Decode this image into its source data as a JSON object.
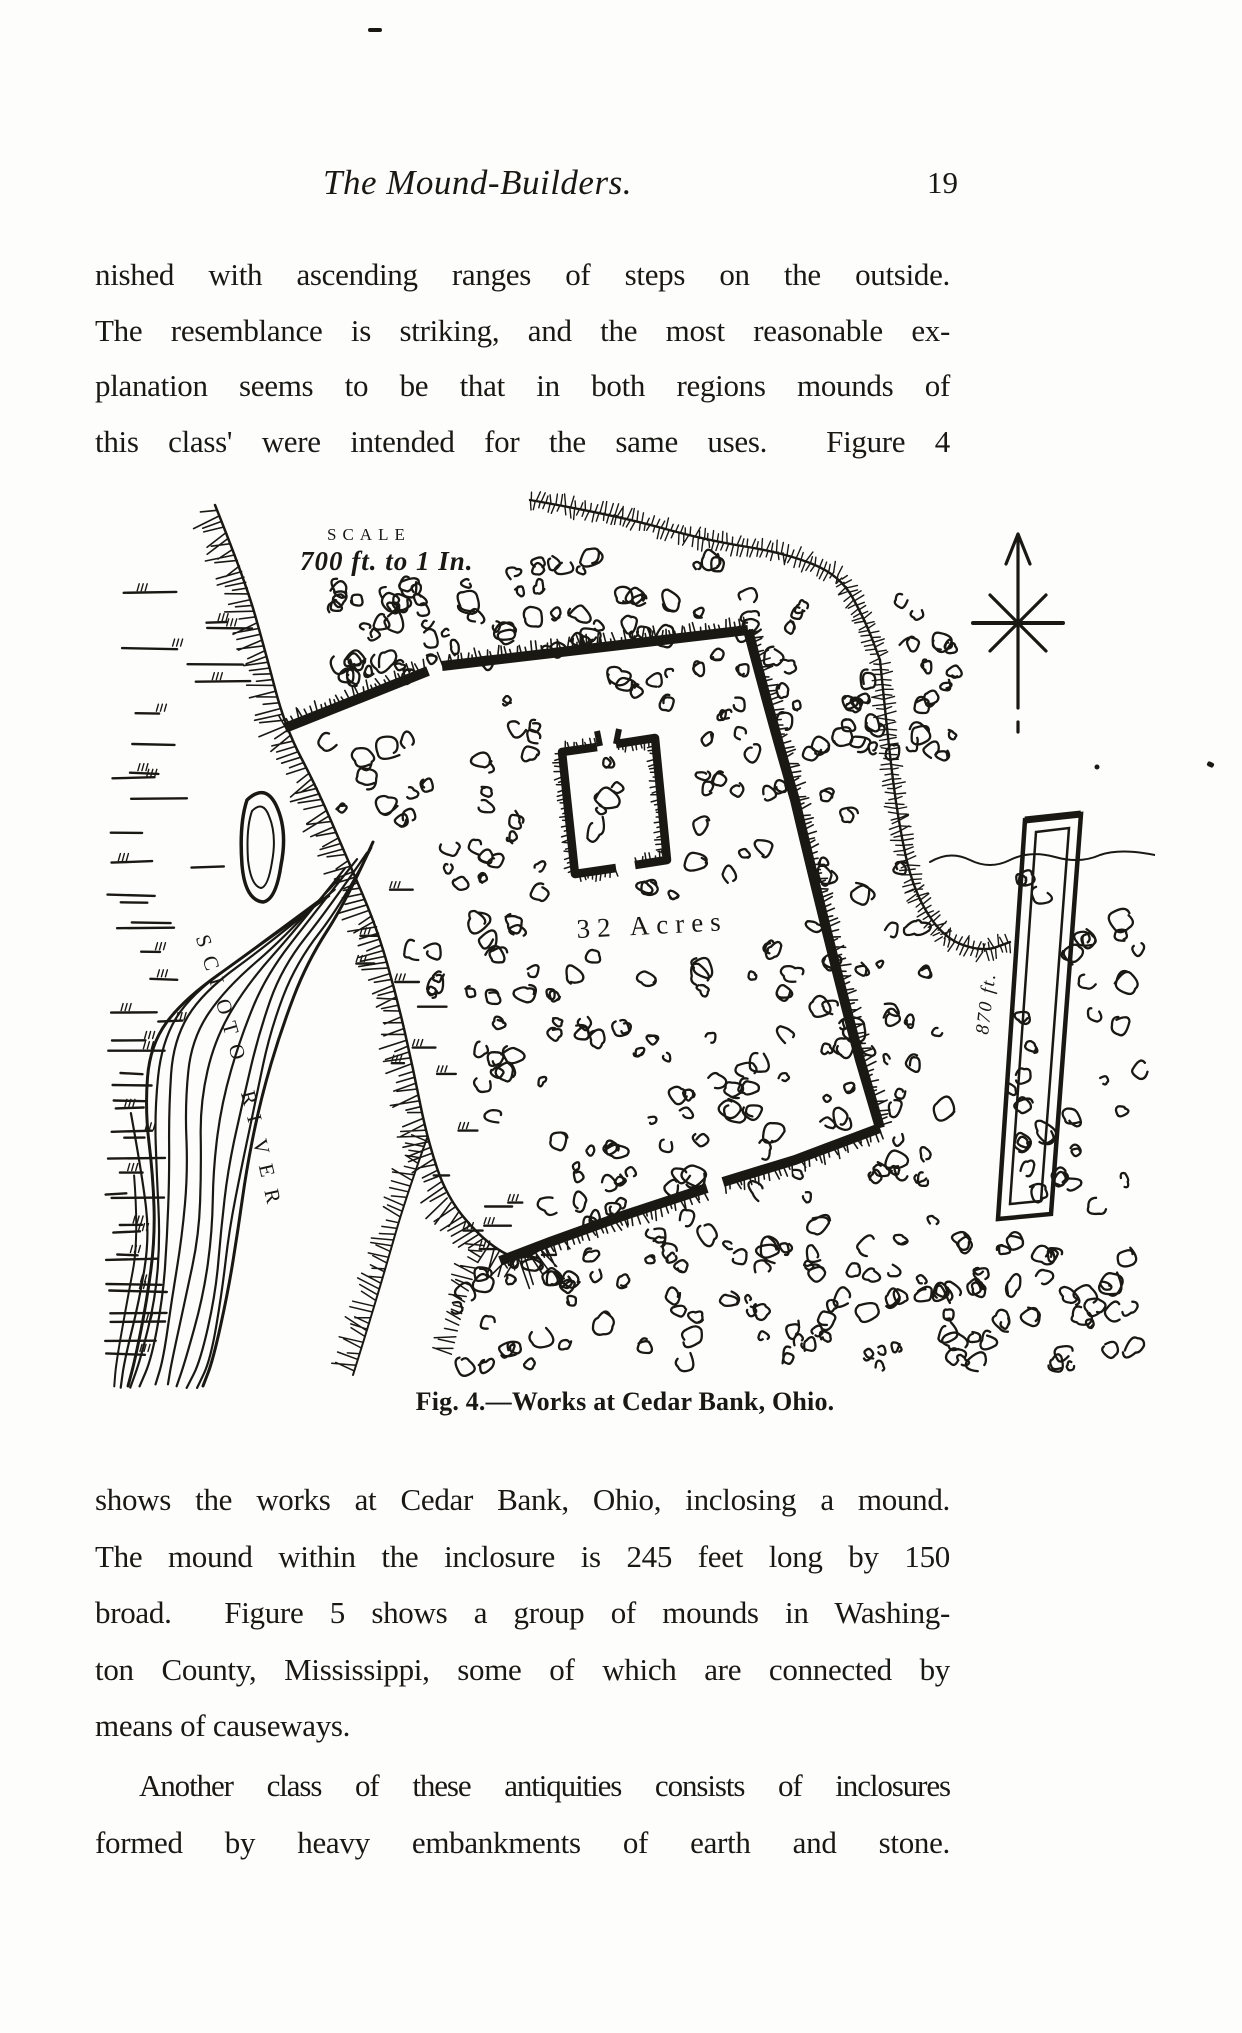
{
  "header": {
    "title": "The Mound-Builders.",
    "page_number": "19"
  },
  "body": {
    "para1": {
      "indent": false,
      "ragged_last": false,
      "lines": [
        "nished with ascending ranges of steps on the outside.",
        "The resemblance is striking, and the most reasonable ex-",
        "planation seems to be that in both regions mounds of",
        "this class' were intended for the same uses.  Figure 4"
      ]
    },
    "para2": {
      "indent": false,
      "ragged_last": true,
      "lines": [
        "shows the works at Cedar Bank, Ohio, inclosing a mound.",
        "The mound within the inclosure is 245 feet long by 150",
        "broad.  Figure 5 shows a group of mounds in Washing-",
        "ton County, Mississippi, some of which are connected by",
        "means of causeways."
      ]
    },
    "para3": {
      "indent": true,
      "ragged_last": false,
      "lines": [
        "Another class of these antiquities consists of inclosures",
        "formed by heavy embankments of earth and stone."
      ]
    }
  },
  "figure": {
    "scale_top": "SCALE",
    "scale_bottom": "700 ft. to 1 In.",
    "acres_label": "32 Acres",
    "river_label": "SCIOTO RIVER",
    "embankment_label": "870 ft.",
    "caption": "Fig. 4.—Works at Cedar Bank, Ohio."
  },
  "colors": {
    "ink": "#1a1813",
    "paper": "#fdfdfc"
  }
}
